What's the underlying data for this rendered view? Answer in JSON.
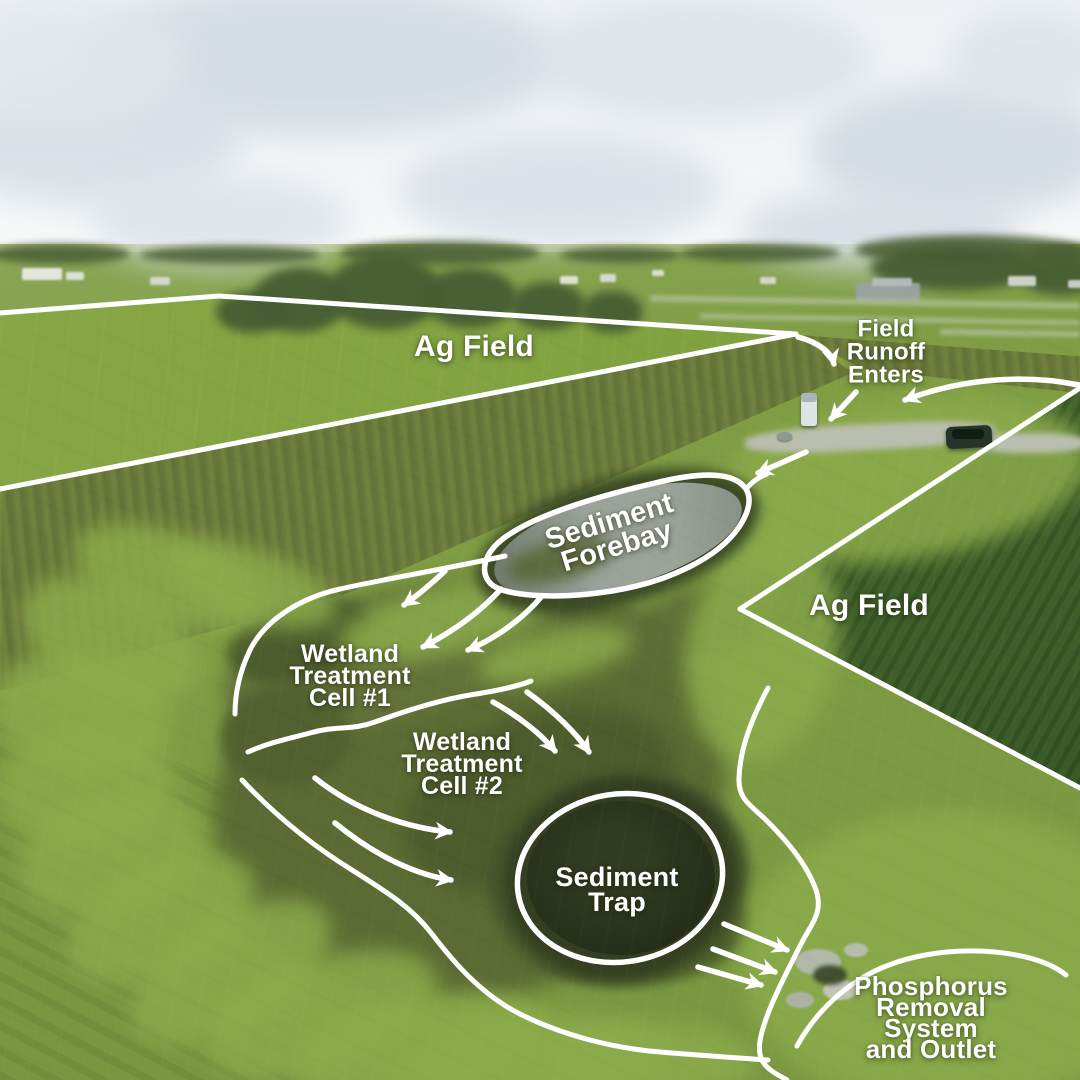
{
  "title": "Edge-of-field wetland water treatment system — annotated aerial view",
  "palette": {
    "annotation": "#ffffff",
    "sky": "#eef1f4",
    "cloud": "#d3dbe3",
    "grass_bright": "#8cab4b",
    "grass_base": "#7d9a41",
    "rough_olive": "#6b7a39",
    "corn_field": "#3f602b",
    "wetland_vegetation": "#55652f",
    "forebay_water": "#929c93",
    "trap_water": "#2a3419"
  },
  "labels": {
    "ag_field_left": "Ag Field",
    "field_runoff_enters": "Field\nRunoff\nEnters",
    "sediment_forebay": "Sediment\nForebay",
    "ag_field_right": "Ag Field",
    "wetland_cell_1": "Wetland\nTreatment\nCell #1",
    "wetland_cell_2": "Wetland\nTreatment\nCell #2",
    "sediment_trap": "Sediment\nTrap",
    "phosphorus_system": "Phosphorus\nRemoval\nSystem\nand Outlet"
  }
}
